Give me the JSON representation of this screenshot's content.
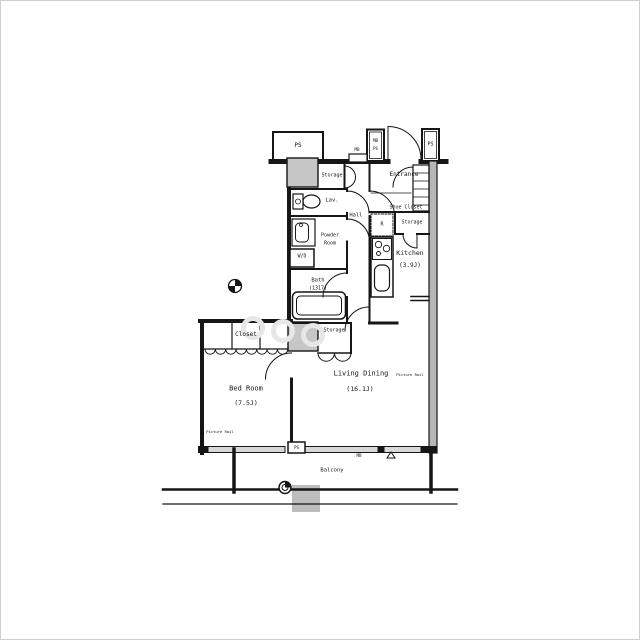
{
  "floorplan": {
    "rooms": [
      {
        "name": "Living Dining",
        "size": "(16.1J)"
      },
      {
        "name": "Bed Room",
        "size": "(7.5J)"
      },
      {
        "name": "Kitchen",
        "size": "(3.9J)"
      },
      {
        "name": "Bath",
        "size": "(1317)"
      }
    ],
    "areas": {
      "entrance": "Entrance",
      "shoe_closet": "Shoe Closet",
      "hall": "Hall",
      "lav": "Lav.",
      "powder_room_line1": "Powder",
      "powder_room_line2": "Room",
      "closet": "Closet",
      "balcony": "Balcony",
      "storage_top": "Storage",
      "storage_entry": "Storage",
      "storage_lower": "Storage"
    },
    "equipment": {
      "washer_dryer": "W/D",
      "refrigerator": "R"
    },
    "shafts": {
      "ps_top_left": "PS",
      "mb_ps_top_line1": "MB",
      "mb_ps_top_line2": "PS",
      "ps_top_right": "PS",
      "mb_top": "MB",
      "ps_balcony": "PS",
      "mb_bottom": "MB"
    },
    "annotations": {
      "picture_rail_living": "Picture Rail",
      "picture_rail_bedroom": "Picture Rail"
    },
    "palette": {
      "line": "#161616",
      "shaft_fill": "#c6c6c6",
      "concrete_wall_fill": "#b6b6b6",
      "window_fill": "#d8d8d8",
      "balcony_hatch_fill": "#bdbdbd"
    }
  }
}
